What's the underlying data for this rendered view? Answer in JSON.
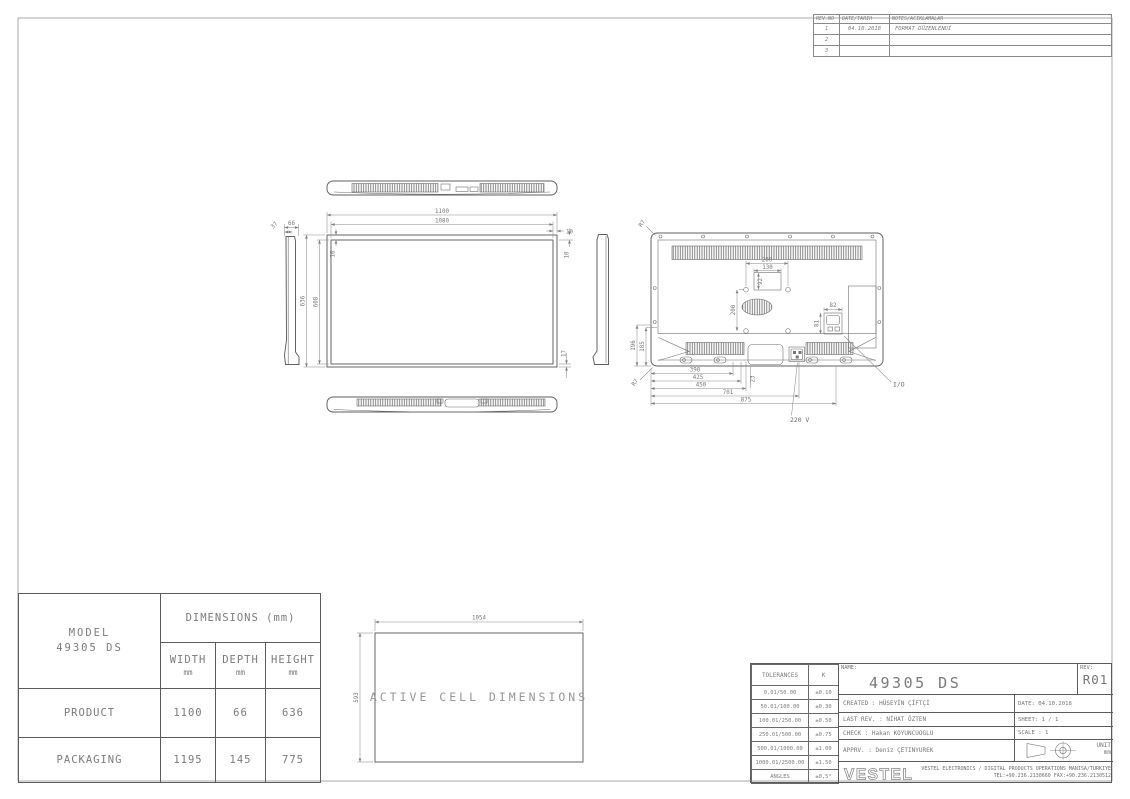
{
  "colors": {
    "background": "#ffffff",
    "line": "#5f5f5f",
    "dim_line": "#8c8c8c",
    "text": "#787878"
  },
  "revision_table": {
    "headers": {
      "no": "REV.NO",
      "date": "DATE/TARIH",
      "notes": "NOTES/ACIKLAMALAR"
    },
    "rows": [
      {
        "no": "1",
        "date": "04.10.2018",
        "notes": "FORMAT DÜZENLENDİ"
      },
      {
        "no": "2",
        "date": "",
        "notes": ""
      },
      {
        "no": "3",
        "date": "",
        "notes": ""
      }
    ]
  },
  "views": {
    "front": {
      "w_outer": "1100",
      "w_inner": "1080",
      "h_outer": "636",
      "h_inner": "608",
      "bezel_top_left": "10",
      "bezel_side": "10",
      "bezel_top_right": "10",
      "bezel_bottom": "17"
    },
    "side": {
      "d1": "37",
      "d2": "66"
    },
    "rear": {
      "vesa_w": "200",
      "vesa_w_inner": "130",
      "vesa_h_inner": "92",
      "vesa_h": "200",
      "io_w": "82",
      "io_h": "81",
      "h1": "196",
      "h2": "185",
      "b1": "390",
      "b2": "425",
      "b3": "450",
      "b4": "701",
      "b5": "875",
      "off": "23",
      "r_top": "R7",
      "r_bottom": "R7",
      "label_power": "220 V",
      "label_io": "I/O"
    },
    "active_cell": {
      "w": "1054",
      "h": "593",
      "label": "ACTIVE CELL DIMENSIONS"
    }
  },
  "model_table": {
    "model_label": "MODEL",
    "model_value": "49305 DS",
    "dims_header": "DIMENSIONS (mm)",
    "cols": [
      {
        "name": "WIDTH",
        "unit": "mm"
      },
      {
        "name": "DEPTH",
        "unit": "mm"
      },
      {
        "name": "HEIGHT",
        "unit": "mm"
      }
    ],
    "rows": [
      {
        "label": "PRODUCT",
        "width": "1100",
        "depth": "66",
        "height": "636"
      },
      {
        "label": "PACKAGING",
        "width": "1195",
        "depth": "145",
        "height": "775"
      }
    ]
  },
  "title_block": {
    "tolerances": {
      "h1": "TOLERANCES",
      "h2": "K",
      "rows": [
        {
          "range": "0.01/50.00",
          "tol": "±0.10"
        },
        {
          "range": "50.01/100.00",
          "tol": "±0.30"
        },
        {
          "range": "100.01/250.00",
          "tol": "±0.50"
        },
        {
          "range": "250.01/500.00",
          "tol": "±0.75"
        },
        {
          "range": "500.01/1000.00",
          "tol": "±1.00"
        },
        {
          "range": "1000.01/2500.00",
          "tol": "±1.50"
        },
        {
          "range": "ANGLES",
          "tol": "±0,5°"
        }
      ]
    },
    "name_label": "NAME:",
    "name_value": "49305 DS",
    "rev_label": "REV:",
    "rev_value": "R01",
    "created": "CREATED : HÜSEYİN ÇİFTÇİ",
    "last_rev": "LAST REV. : NİHAT ÖZTEN",
    "check": "CHECK : Hakan KOYUNCUOGLU",
    "apprv": "APPRV. : Deniz ÇETINYUREK",
    "date": "DATE: 04.10.2018",
    "sheet_no": "SHEET: 1 / 1",
    "scale": "SCALE : 1",
    "unit_label": "UNIT",
    "unit_value": "mm",
    "logo": "VESTEL",
    "company_1": "VESTEL ELECTRONICS / DIGITAL PRODUCTS OPERATIONS MANISA/TURKIYE",
    "company_2": "TEL:+90.236.2130660 FAX:+90.236.2130512"
  }
}
